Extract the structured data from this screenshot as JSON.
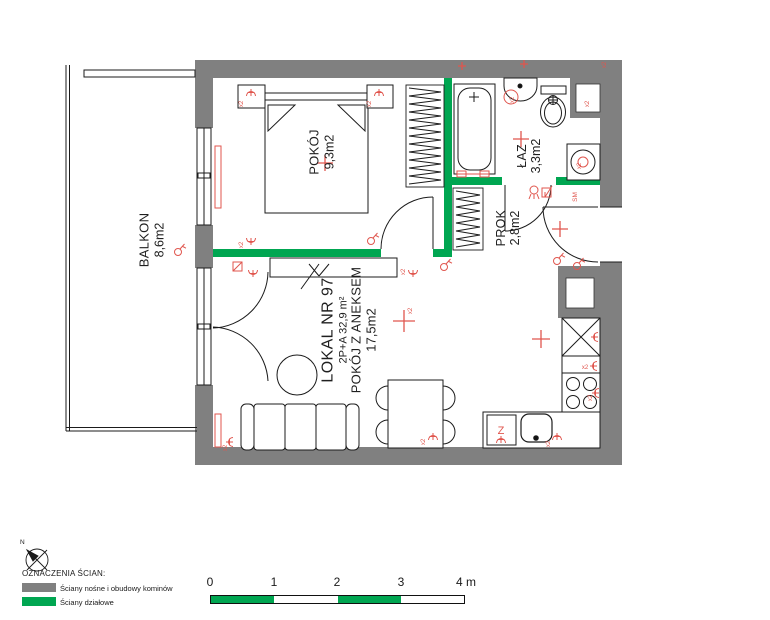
{
  "plan": {
    "unit": {
      "number": "LOKAL NR 97",
      "type_area": "2P+A  32,9 m²",
      "name": "POKÓJ Z ANEKSEM",
      "area": "17,5m2"
    },
    "rooms": {
      "balcony": {
        "name": "BALKON",
        "area": "8,6m2"
      },
      "bedroom": {
        "name": "POKÓJ",
        "area": "9,3m2"
      },
      "bathroom": {
        "name": "ŁAZ",
        "area": "3,3m2"
      },
      "hall": {
        "name": "PROK",
        "area": "2,8m2"
      }
    },
    "symbols": {
      "double_socket": "x2",
      "smoke_detector": "SM",
      "dishwasher": "Z"
    }
  },
  "legend": {
    "compass_north": "N",
    "title": "OZNACZENIA ŚCIAN:",
    "items": [
      {
        "label": "Ściany nośne i obudowy kominów",
        "color": "#808080"
      },
      {
        "label": "Ściany działowe",
        "color": "#00A651"
      }
    ]
  },
  "scalebar": {
    "ticks": [
      "0",
      "1",
      "2",
      "3"
    ],
    "end_label": "4 m"
  },
  "colors": {
    "load_bearing_wall": "#808080",
    "partition_wall": "#00A651",
    "electrical_symbols": "#E0564E"
  }
}
